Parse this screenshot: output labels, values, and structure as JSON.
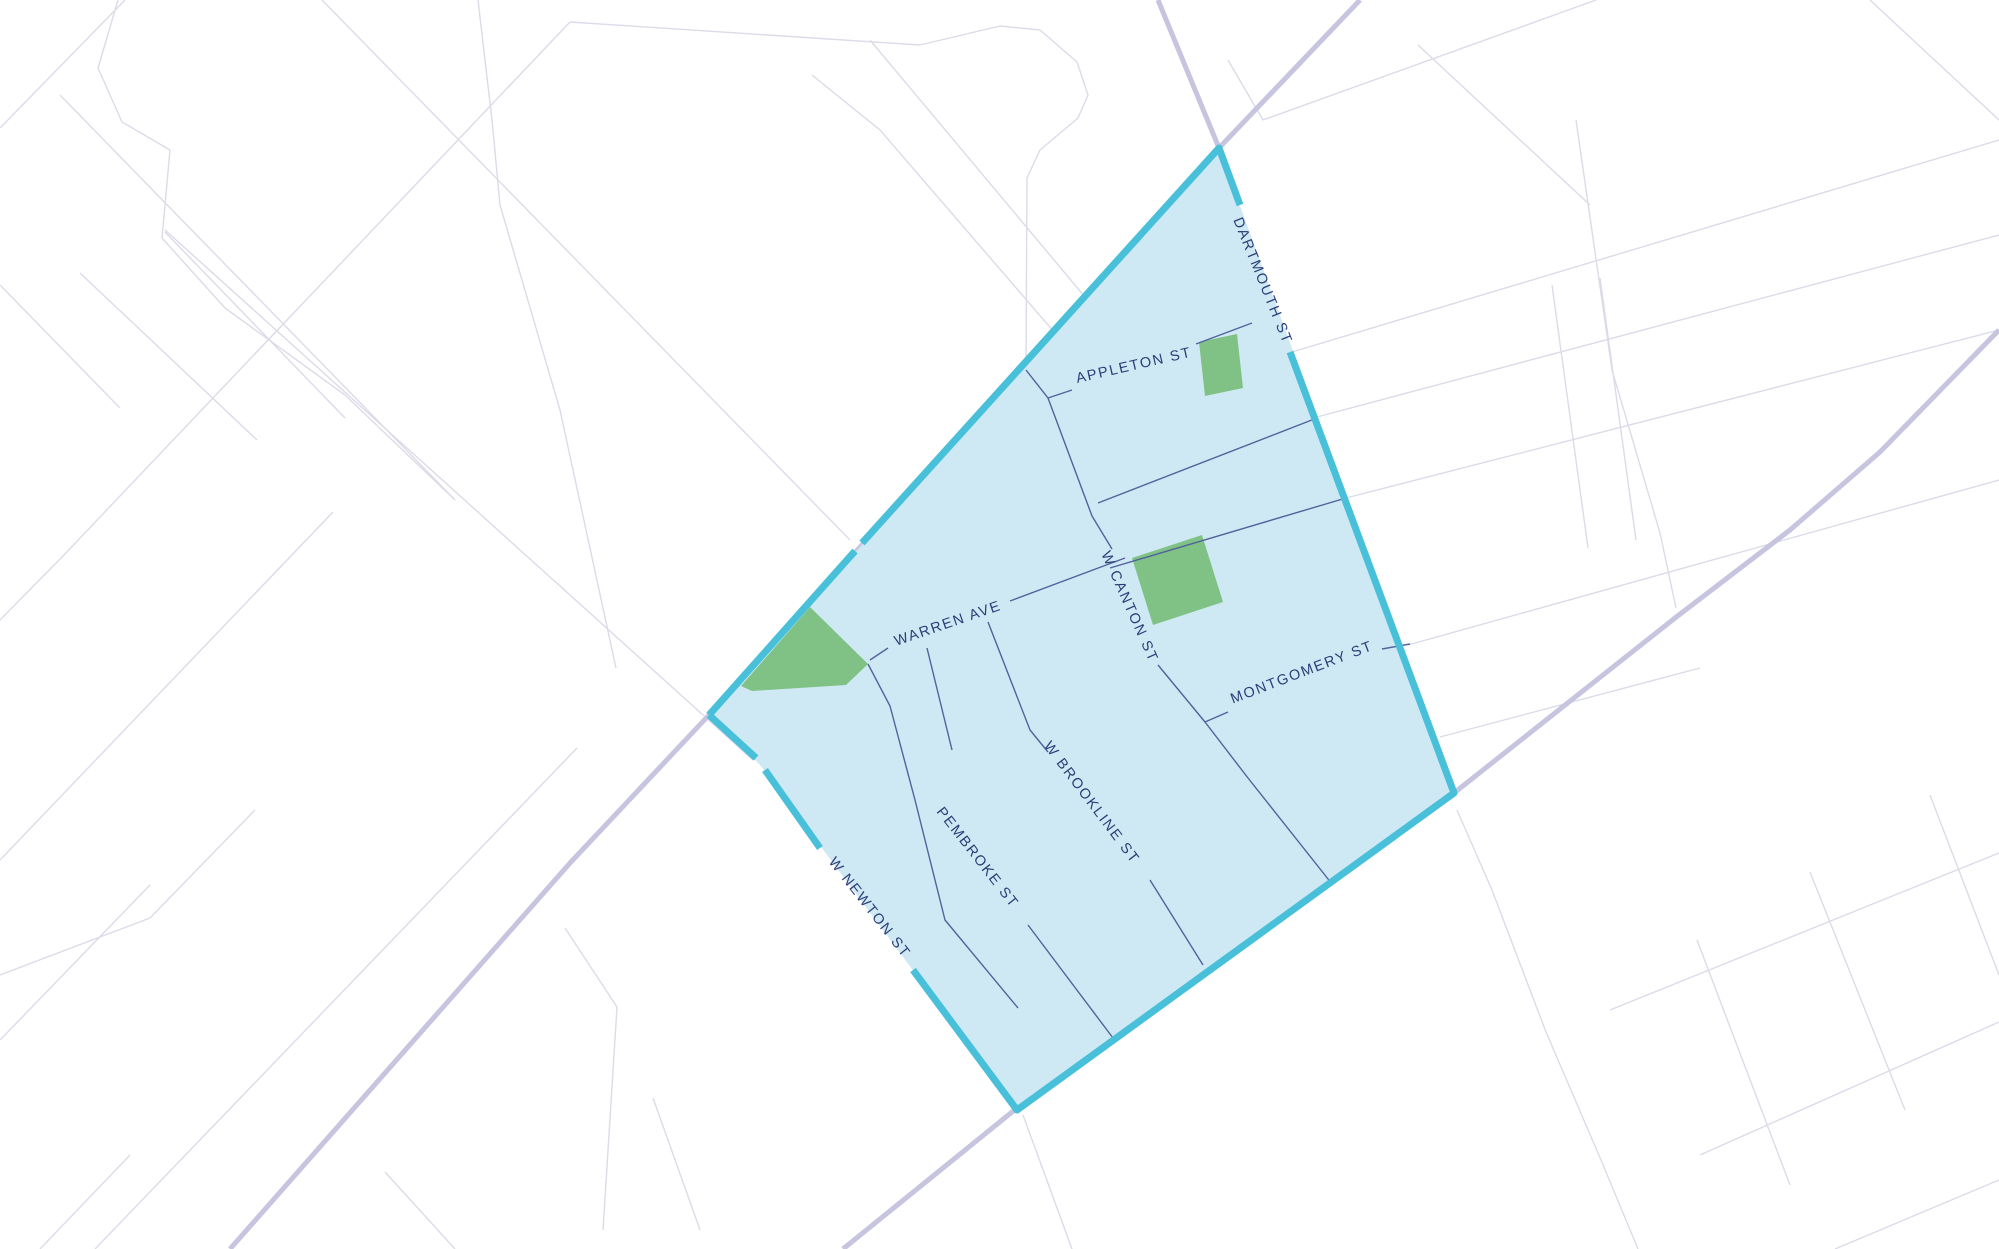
{
  "map": {
    "colors": {
      "background": "#ffffff",
      "minor_street": "#dbdbe9",
      "major_road": "#c6c4df",
      "region_fill": "#cee9f3",
      "region_border": "#49c0d9",
      "interior_street": "#51639b",
      "park_fill": "#80c286",
      "label_text": "#2b3e78"
    },
    "street_labels": [
      {
        "id": "dartmouth-st",
        "text": "DARTMOUTH ST",
        "x": 1262,
        "y": 281,
        "rotation": 68
      },
      {
        "id": "appleton-st",
        "text": "APPLETON ST",
        "x": 1134,
        "y": 366,
        "rotation": -13
      },
      {
        "id": "w-canton-st",
        "text": "W CANTON ST",
        "x": 1129,
        "y": 607,
        "rotation": 66
      },
      {
        "id": "warren-ave",
        "text": "WARREN AVE",
        "x": 948,
        "y": 624,
        "rotation": -19
      },
      {
        "id": "montgomery-st",
        "text": "MONTGOMERY ST",
        "x": 1302,
        "y": 673,
        "rotation": -21
      },
      {
        "id": "w-brookline-st",
        "text": "W BROOKLINE ST",
        "x": 1091,
        "y": 803,
        "rotation": 53
      },
      {
        "id": "pembroke-st",
        "text": "PEMBROKE ST",
        "x": 977,
        "y": 858,
        "rotation": 52
      },
      {
        "id": "w-newton-st",
        "text": "W NEWTON ST",
        "x": 869,
        "y": 908,
        "rotation": 52
      }
    ],
    "region": {
      "fill_polygon": [
        [
          1219,
          148
        ],
        [
          1454,
          793
        ],
        [
          1017,
          1110
        ],
        [
          760,
          765
        ],
        [
          709,
          715
        ]
      ],
      "border_segments": [
        [
          [
            709,
            715
          ],
          [
            855,
            551
          ]
        ],
        [
          [
            862,
            543
          ],
          [
            1219,
            148
          ],
          [
            1240,
            205
          ]
        ],
        [
          [
            1290,
            352
          ],
          [
            1454,
            793
          ],
          [
            1017,
            1110
          ],
          [
            913,
            970
          ]
        ],
        [
          [
            820,
            848
          ],
          [
            765,
            770
          ]
        ],
        [
          [
            756,
            758
          ],
          [
            709,
            715
          ]
        ]
      ],
      "interior_streets": [
        [
          [
            1026,
            370
          ],
          [
            1048,
            398
          ],
          [
            1092,
            516
          ],
          [
            1112,
            549
          ]
        ],
        [
          [
            1158,
            665
          ],
          [
            1205,
            722
          ],
          [
            1248,
            778
          ],
          [
            1332,
            884
          ]
        ],
        [
          [
            1048,
            398
          ],
          [
            1072,
            390
          ]
        ],
        [
          [
            1196,
            344
          ],
          [
            1252,
            323
          ]
        ],
        [
          [
            870,
            660
          ],
          [
            888,
            648
          ]
        ],
        [
          [
            1010,
            601
          ],
          [
            1125,
            558
          ]
        ],
        [
          [
            1205,
            722
          ],
          [
            1228,
            712
          ]
        ],
        [
          [
            1382,
            649
          ],
          [
            1410,
            644
          ]
        ],
        [
          [
            1098,
            503
          ],
          [
            1317,
            418
          ]
        ],
        [
          [
            1110,
            568
          ],
          [
            1346,
            498
          ]
        ],
        [
          [
            927,
            648
          ],
          [
            952,
            750
          ]
        ],
        [
          [
            1028,
            925
          ],
          [
            1113,
            1038
          ]
        ],
        [
          [
            868,
            664
          ],
          [
            890,
            706
          ],
          [
            915,
            800
          ],
          [
            945,
            920
          ],
          [
            1018,
            1008
          ]
        ],
        [
          [
            988,
            622
          ],
          [
            1030,
            730
          ],
          [
            1048,
            752
          ]
        ],
        [
          [
            1150,
            880
          ],
          [
            1203,
            965
          ]
        ]
      ],
      "parks": [
        [
          [
            1199,
            342
          ],
          [
            1237,
            334
          ],
          [
            1243,
            388
          ],
          [
            1205,
            396
          ]
        ],
        [
          [
            1132,
            558
          ],
          [
            1202,
            535
          ],
          [
            1223,
            602
          ],
          [
            1153,
            625
          ]
        ],
        [
          [
            810,
            607
          ],
          [
            868,
            664
          ],
          [
            846,
            685
          ],
          [
            752,
            691
          ],
          [
            741,
            686
          ]
        ]
      ]
    },
    "background": {
      "major_roads": [
        [
          [
            1158,
            0
          ],
          [
            1219,
            148
          ],
          [
            709,
            715
          ],
          [
            570,
            863
          ],
          [
            230,
            1249
          ]
        ],
        [
          [
            1360,
            0
          ],
          [
            1219,
            148
          ]
        ],
        [
          [
            843,
            1249
          ],
          [
            1017,
            1108
          ],
          [
            1454,
            793
          ],
          [
            1675,
            618
          ],
          [
            1790,
            530
          ],
          [
            1880,
            452
          ],
          [
            1999,
            330
          ]
        ]
      ],
      "minor_streets": [
        [
          [
            0,
            128
          ],
          [
            125,
            0
          ]
        ],
        [
          [
            0,
            620
          ],
          [
            63,
            556
          ],
          [
            570,
            22
          ]
        ],
        [
          [
            0,
            860
          ],
          [
            333,
            512
          ]
        ],
        [
          [
            95,
            1249
          ],
          [
            577,
            748
          ]
        ],
        [
          [
            0,
            1040
          ],
          [
            150,
            885
          ]
        ],
        [
          [
            40,
            1249
          ],
          [
            130,
            1155
          ]
        ],
        [
          [
            60,
            95
          ],
          [
            455,
            500
          ]
        ],
        [
          [
            118,
            0
          ],
          [
            98,
            68
          ],
          [
            122,
            122
          ],
          [
            170,
            150
          ]
        ],
        [
          [
            170,
            150
          ],
          [
            162,
            238
          ],
          [
            225,
            308
          ],
          [
            345,
            395
          ],
          [
            455,
            500
          ]
        ],
        [
          [
            322,
            0
          ],
          [
            850,
            540
          ]
        ],
        [
          [
            478,
            0
          ],
          [
            492,
            120
          ],
          [
            500,
            205
          ],
          [
            560,
            410
          ],
          [
            616,
            668
          ]
        ],
        [
          [
            257,
            440
          ],
          [
            80,
            273
          ]
        ],
        [
          [
            0,
            285
          ],
          [
            120,
            408
          ]
        ],
        [
          [
            165,
            232
          ],
          [
            345,
            418
          ]
        ],
        [
          [
            0,
            975
          ],
          [
            150,
            918
          ]
        ],
        [
          [
            150,
            918
          ],
          [
            255,
            810
          ]
        ],
        [
          [
            570,
            22
          ],
          [
            920,
            45
          ]
        ],
        [
          [
            920,
            45
          ],
          [
            1000,
            26
          ],
          [
            1040,
            30
          ],
          [
            1077,
            62
          ],
          [
            1088,
            95
          ],
          [
            1078,
            118
          ],
          [
            1040,
            150
          ],
          [
            1027,
            178
          ],
          [
            1026,
            368
          ]
        ],
        [
          [
            880,
            130
          ],
          [
            1055,
            333
          ]
        ],
        [
          [
            812,
            75
          ],
          [
            880,
            130
          ]
        ],
        [
          [
            870,
            40
          ],
          [
            1085,
            297
          ]
        ],
        [
          [
            1263,
            120
          ],
          [
            1596,
            0
          ]
        ],
        [
          [
            1228,
            60
          ],
          [
            1263,
            120
          ]
        ],
        [
          [
            1292,
            352
          ],
          [
            1999,
            140
          ]
        ],
        [
          [
            1317,
            417
          ],
          [
            1999,
            235
          ]
        ],
        [
          [
            1346,
            498
          ],
          [
            1999,
            330
          ]
        ],
        [
          [
            1408,
            645
          ],
          [
            1999,
            480
          ]
        ],
        [
          [
            1440,
            737
          ],
          [
            1700,
            668
          ]
        ],
        [
          [
            1457,
            810
          ],
          [
            1492,
            890
          ],
          [
            1546,
            1032
          ],
          [
            1601,
            1160
          ],
          [
            1638,
            1249
          ]
        ],
        [
          [
            1418,
            45
          ],
          [
            1590,
            205
          ]
        ],
        [
          [
            1576,
            120
          ],
          [
            1612,
            370
          ],
          [
            1660,
            533
          ],
          [
            1676,
            608
          ]
        ],
        [
          [
            1870,
            0
          ],
          [
            1999,
            120
          ]
        ],
        [
          [
            1552,
            285
          ],
          [
            1588,
            548
          ]
        ],
        [
          [
            1600,
            278
          ],
          [
            1636,
            540
          ]
        ],
        [
          [
            1610,
            1010
          ],
          [
            1999,
            853
          ]
        ],
        [
          [
            1700,
            1155
          ],
          [
            1999,
            1022
          ]
        ],
        [
          [
            1835,
            1249
          ],
          [
            1999,
            1180
          ]
        ],
        [
          [
            1697,
            940
          ],
          [
            1790,
            1185
          ]
        ],
        [
          [
            1810,
            872
          ],
          [
            1905,
            1110
          ]
        ],
        [
          [
            1930,
            795
          ],
          [
            1999,
            975
          ]
        ],
        [
          [
            1023,
            1115
          ],
          [
            1072,
            1249
          ]
        ],
        [
          [
            565,
            928
          ],
          [
            617,
            1007
          ],
          [
            603,
            1230
          ]
        ],
        [
          [
            653,
            1098
          ],
          [
            700,
            1230
          ]
        ],
        [
          [
            385,
            1172
          ],
          [
            455,
            1249
          ]
        ],
        [
          [
            165,
            230
          ],
          [
            753,
            760
          ]
        ]
      ]
    }
  }
}
